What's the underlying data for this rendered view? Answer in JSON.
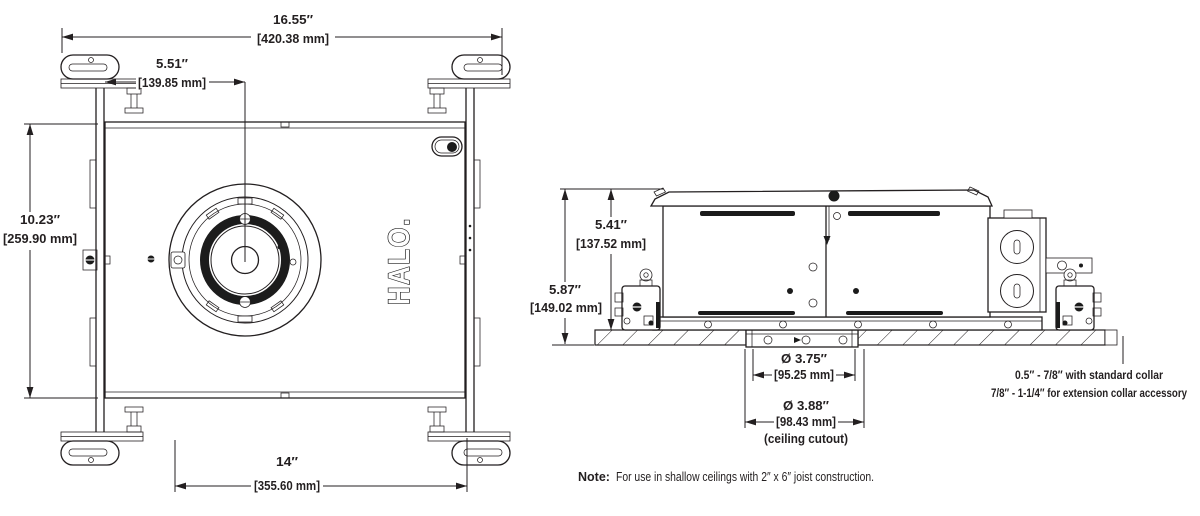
{
  "drawing": {
    "background": "#ffffff",
    "line_color": "#231f20"
  },
  "plan_view": {
    "logo_text": "HALO.",
    "dims": {
      "overall_width_in": "16.55″",
      "overall_width_mm": "[420.38 mm]",
      "center_offset_in": "5.51″",
      "center_offset_mm": "[139.85 mm]",
      "depth_in": "10.23″",
      "depth_mm": "[259.90 mm]",
      "pan_width_in": "14″",
      "pan_width_mm": "[355.60 mm]"
    }
  },
  "side_view": {
    "dims": {
      "housing_height_in": "5.41″",
      "housing_height_mm": "[137.52 mm]",
      "overall_height_in": "5.87″",
      "overall_height_mm": "[149.02 mm]",
      "aperture_dia_in": "Ø 3.75″",
      "aperture_dia_mm": "[95.25 mm]",
      "cutout_dia_in": "Ø 3.88″",
      "cutout_dia_mm": "[98.43 mm]",
      "cutout_caption": "(ceiling cutout)"
    },
    "collar_note_line1": "0.5″ - 7/8″ with standard collar",
    "collar_note_line2": "7/8″ - 1-1/4″ for extension collar accessory"
  },
  "footnote": {
    "label": "Note:",
    "text": "For use in shallow ceilings with 2″ x 6″ joist construction."
  }
}
